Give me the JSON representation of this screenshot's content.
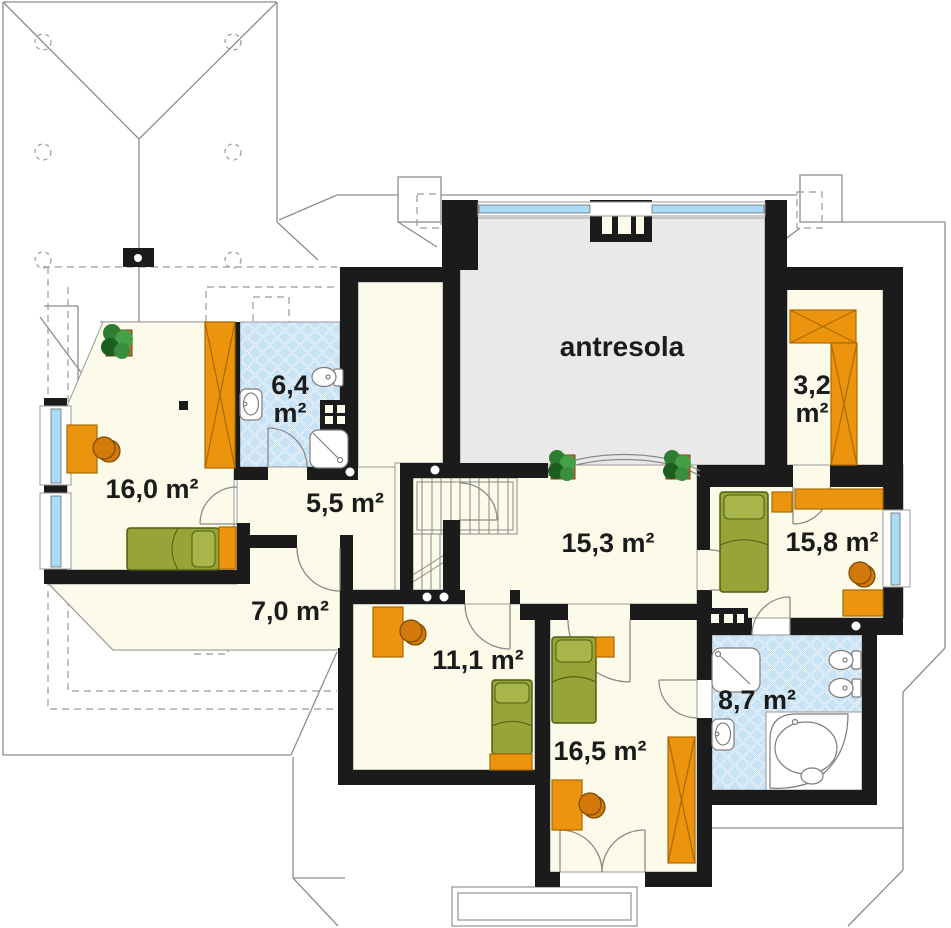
{
  "plan": {
    "mezzanine_label": "antresola",
    "rooms": [
      {
        "name": "bedroom-16-0",
        "area_label": "16,0 m²"
      },
      {
        "name": "bathroom-6-4",
        "area_label": "6,4",
        "area_unit": "m²"
      },
      {
        "name": "hallway-5-5",
        "area_label": "5,5 m²"
      },
      {
        "name": "room-15-3",
        "area_label": "15,3 m²"
      },
      {
        "name": "bedroom-15-8",
        "area_label": "15,8 m²"
      },
      {
        "name": "wardrobe-3-2",
        "area_label": "3,2",
        "area_unit": "m²"
      },
      {
        "name": "room-7-0",
        "area_label": "7,0 m²"
      },
      {
        "name": "room-11-1",
        "area_label": "11,1 m²"
      },
      {
        "name": "bedroom-16-5",
        "area_label": "16,5 m²"
      },
      {
        "name": "bathroom-8-7",
        "area_label": "8,7 m²"
      }
    ],
    "colors": {
      "wall": "#1b1b1b",
      "floor_cream": "#FCFAE9",
      "mezzanine_gray": "#E9E9E9",
      "furniture_orange": "#EC940D",
      "bed_green": "#97A437",
      "tile_blue": "#C9E3F6",
      "window_blue": "#A9DCF7",
      "roof_line": "#8d8d8d"
    }
  }
}
